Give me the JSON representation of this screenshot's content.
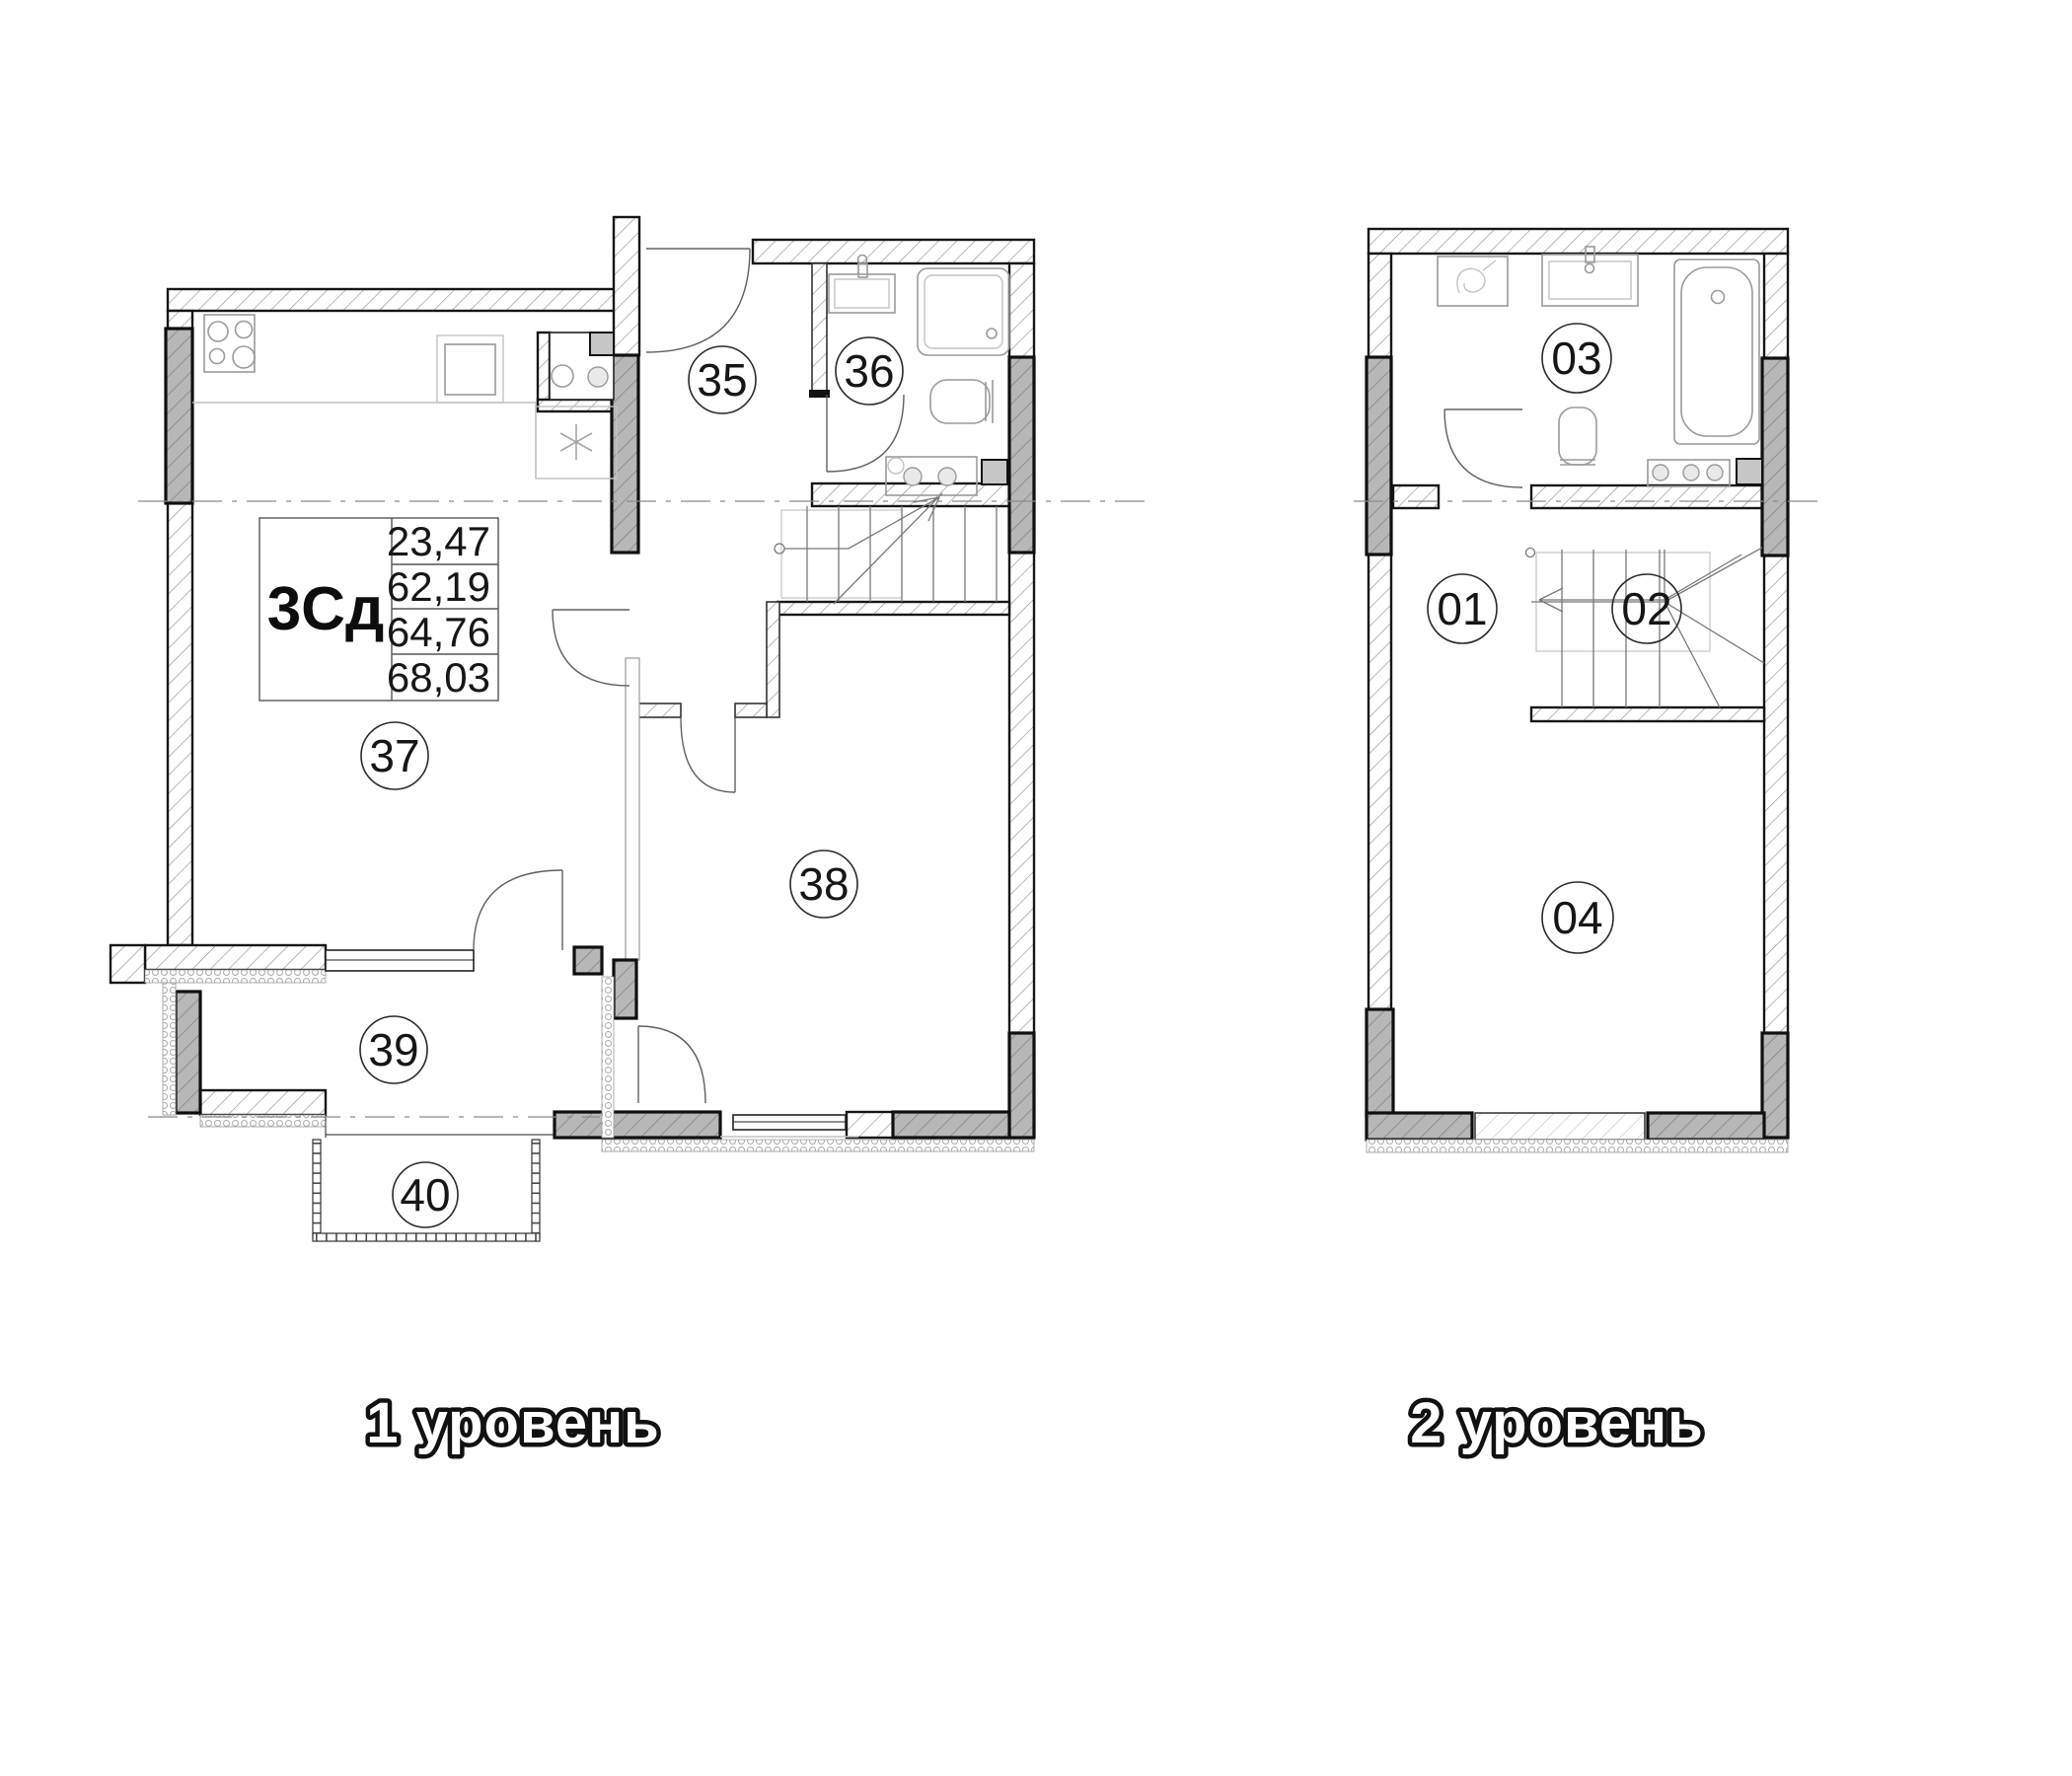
{
  "info_table": {
    "plan_code": "3Сд",
    "values": [
      "23,47",
      "62,19",
      "64,76",
      "68,03"
    ]
  },
  "levels": [
    {
      "label": "1 уровень",
      "rooms": [
        {
          "number": "35"
        },
        {
          "number": "36"
        },
        {
          "number": "37"
        },
        {
          "number": "38"
        },
        {
          "number": "39"
        },
        {
          "number": "40"
        }
      ]
    },
    {
      "label": "2 уровень",
      "rooms": [
        {
          "number": "01"
        },
        {
          "number": "02"
        },
        {
          "number": "03"
        },
        {
          "number": "04"
        }
      ]
    }
  ]
}
